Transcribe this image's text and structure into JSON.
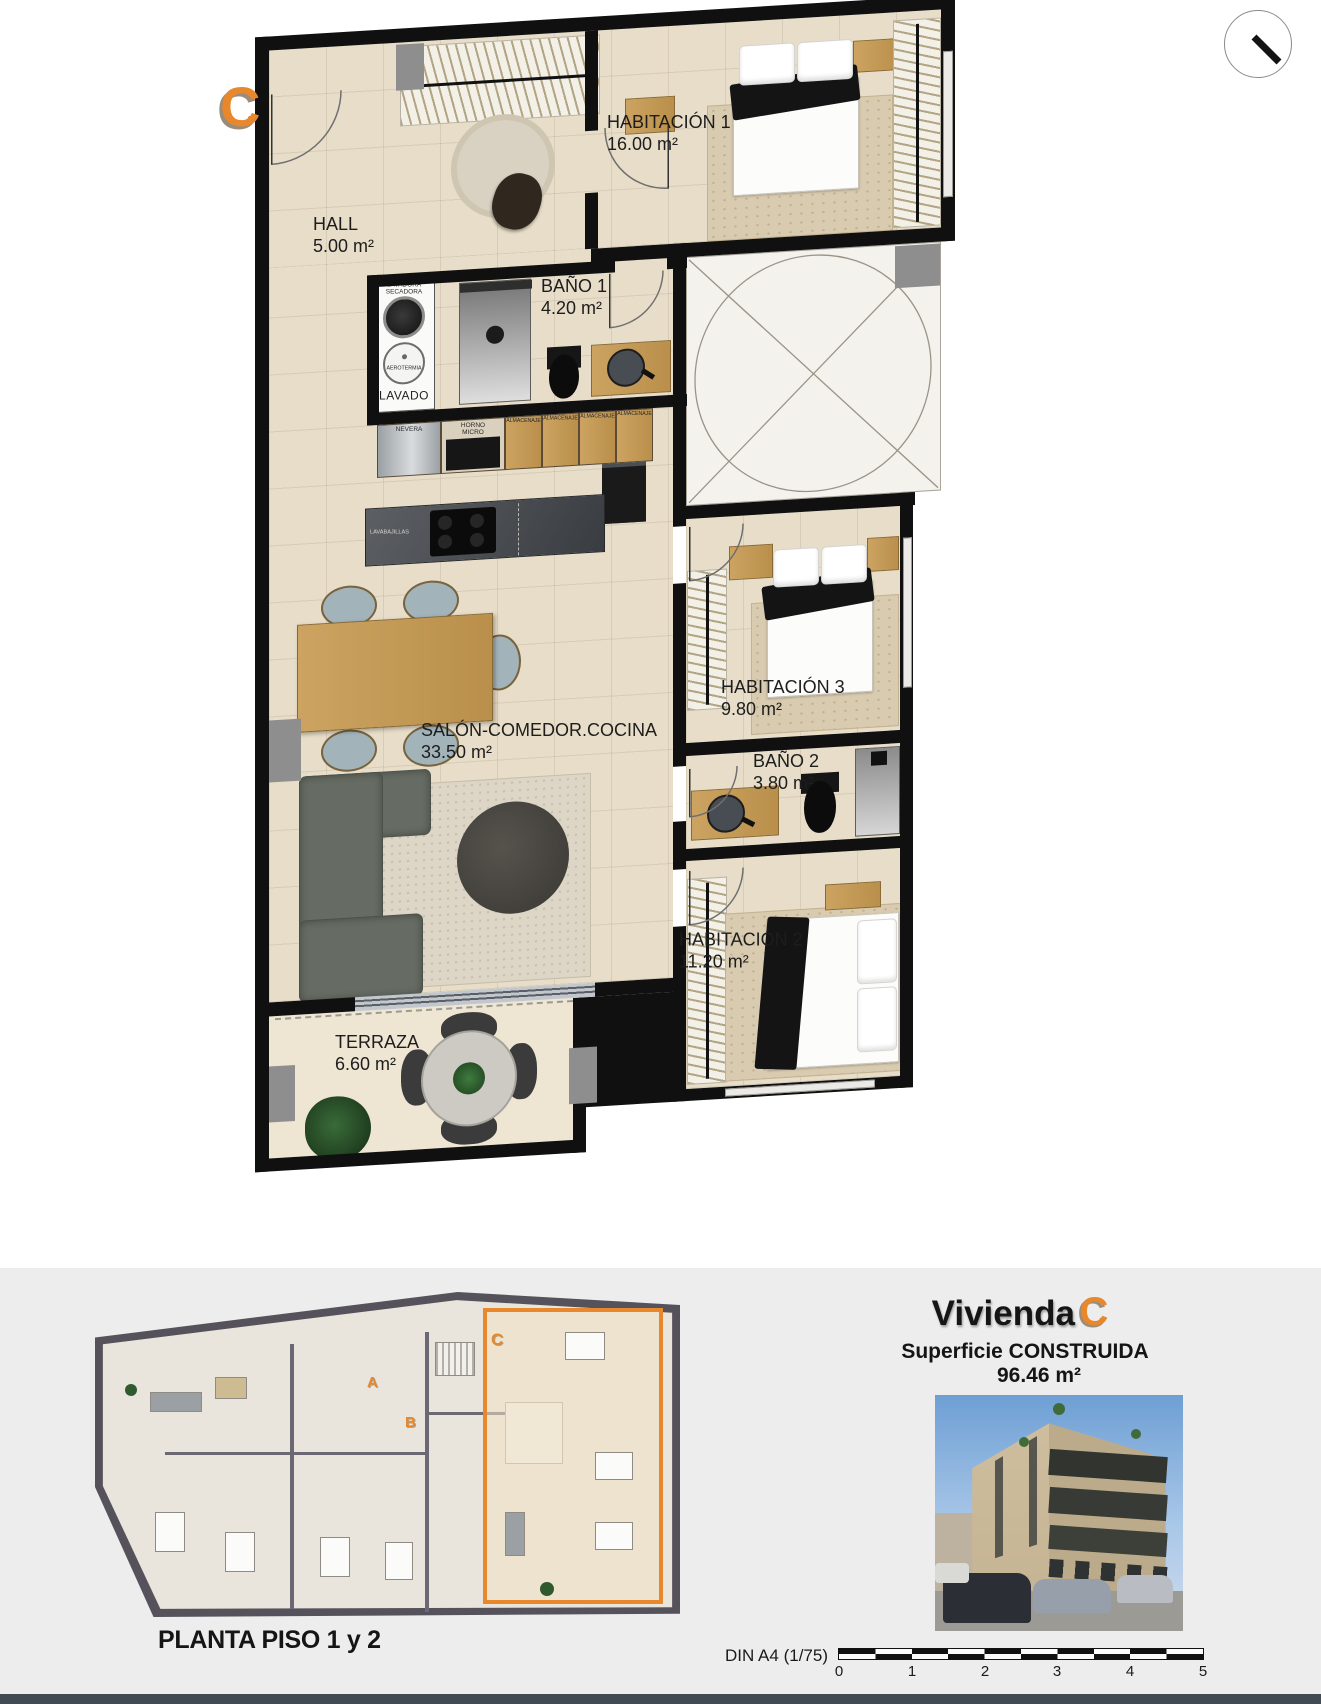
{
  "marker": "C",
  "plan": {
    "rooms": {
      "hall": {
        "name": "HALL",
        "area": "5.00 m²"
      },
      "habitacion1": {
        "name": "HABITACIÓN 1",
        "area": "16.00 m²"
      },
      "bano1": {
        "name": "BAÑO 1",
        "area": "4.20 m²"
      },
      "salon": {
        "name": "SALÓN-COMEDOR.COCINA",
        "area": "33.50 m²"
      },
      "habitacion3": {
        "name": "HABITACIÓN 3",
        "area": "9.80 m²"
      },
      "bano2": {
        "name": "BAÑO 2",
        "area": "3.80 m²"
      },
      "habitacion2": {
        "name": "HABITACIÓN 2",
        "area": "11.20 m²"
      },
      "terraza": {
        "name": "TERRAZA",
        "area": "6.60 m²"
      }
    },
    "appliances": {
      "lavadora_line1": "LAVADORA",
      "lavadora_line2": "SECADORA",
      "aerotermia": "AEROTERMIA",
      "lavado": "LAVADO",
      "nevera": "NEVERA",
      "horno_line1": "HORNO",
      "horno_line2": "MICRO",
      "almacenaje": "ALMACENAJE",
      "lavavajillas": "LAVABAJILLAS"
    }
  },
  "footer": {
    "floor_label": "PLANTA PISO 1 y 2",
    "title_prefix": "Vivienda",
    "title_letter": "C",
    "surface_label": "Superficie CONSTRUIDA",
    "surface_value": "96.46 m²",
    "scale_label": "DIN A4 (1/75)",
    "scale_ticks": [
      "0",
      "1",
      "2",
      "3",
      "4",
      "5"
    ],
    "mini_units": {
      "a": "A",
      "b": "B",
      "c": "C"
    }
  },
  "colors": {
    "accent_orange": "#E8872B",
    "wall_black": "#101010",
    "floor_beige": "#E7DDC8",
    "footer_bg": "#EDEDED"
  }
}
